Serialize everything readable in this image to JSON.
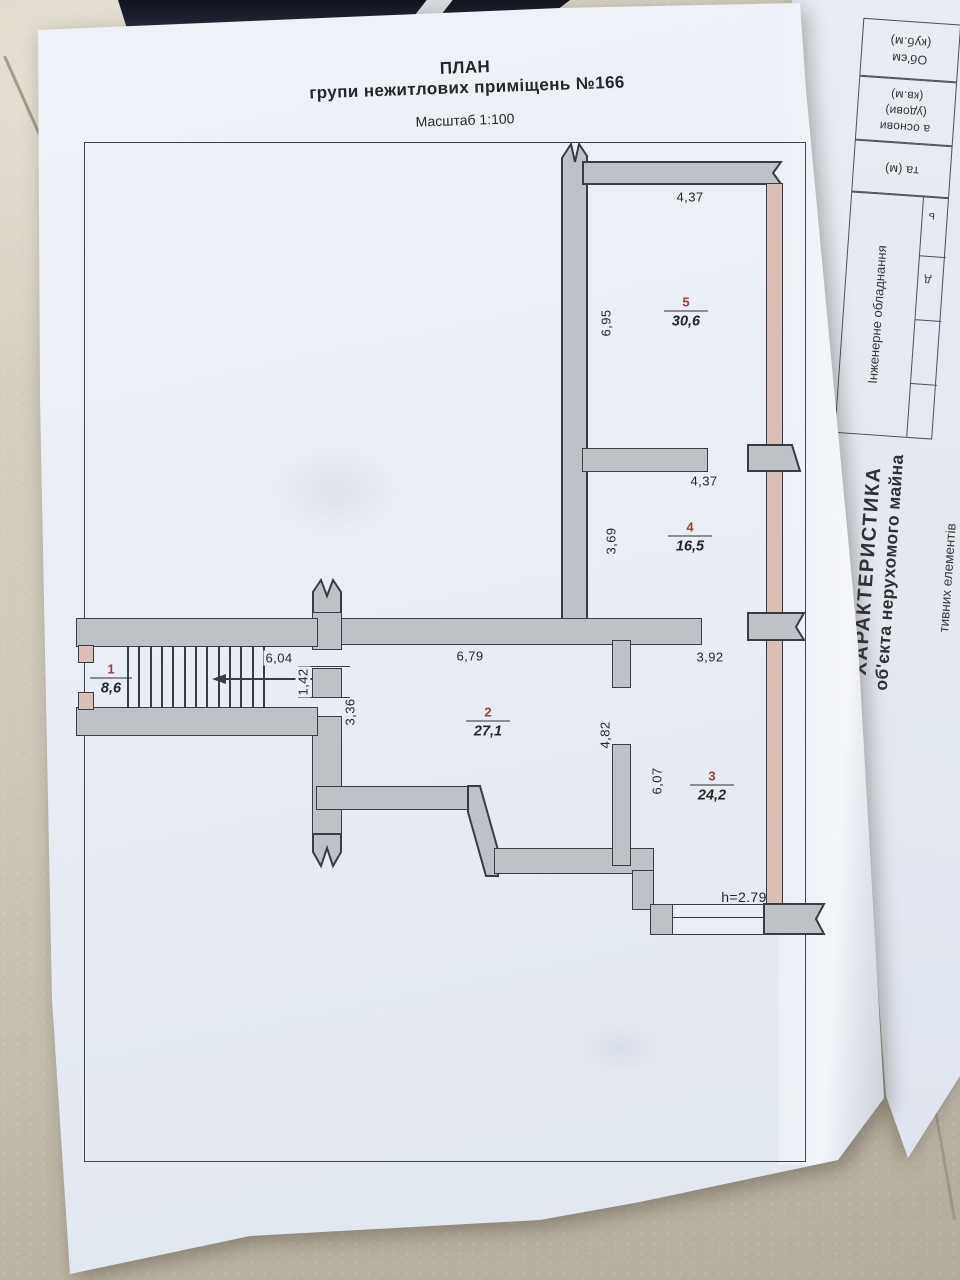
{
  "sheet": {
    "title_line1": "ПЛАН",
    "title_line2": "групи нежитлових приміщень №166",
    "scale": "Масштаб 1:100"
  },
  "rooms": [
    {
      "num": "1",
      "area": "8,6"
    },
    {
      "num": "2",
      "area": "27,1"
    },
    {
      "num": "3",
      "area": "24,2"
    },
    {
      "num": "4",
      "area": "16,5"
    },
    {
      "num": "5",
      "area": "30,6"
    }
  ],
  "dims": {
    "room5_top": "4,37",
    "room5_left": "6,95",
    "room4_top": "4,37",
    "room4_left": "3,69",
    "stair_top": "6,04",
    "corridor_top": "6,79",
    "room3_top": "3,92",
    "door_left": "1,42",
    "room2_left": "3,36",
    "room2_mid": "4,82",
    "room3_left": "6,07",
    "height_note": "h=2.79"
  },
  "back_sheet": {
    "header_line1": "ХАРАКТЕРИСТИКА",
    "header_line2": "об'єкта нерухомого майна",
    "cell_volume_line1": "Об'єм",
    "cell_volume_line2": "(куб.м)",
    "cell_area_line1": "а основи",
    "cell_area_line2": "(удови)",
    "cell_area_line3": "(кв.м)",
    "cell_meters": "та (м)",
    "cell_engineering": "Інженерне обладнання",
    "cell_elements": "тивних елементів",
    "edge_fragment1": "ь",
    "edge_fragment2": "д"
  },
  "colors": {
    "paper": "#e9edf4",
    "line": "#373c45",
    "wall_gray": "#bec2c6",
    "wall_pink": "#d9bfb5",
    "room_number": "#9c3f38"
  }
}
